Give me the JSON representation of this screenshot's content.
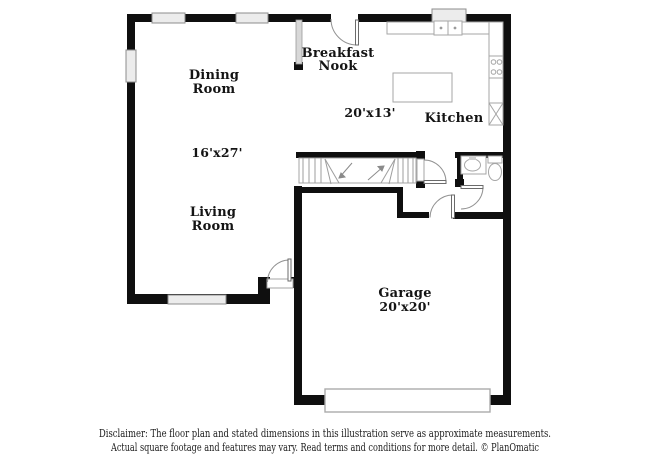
{
  "plan": {
    "rooms": {
      "dining": {
        "line1": "Dining",
        "line2": "Room"
      },
      "breakfast": {
        "line1": "Breakfast",
        "line2": "Nook"
      },
      "kitchen": {
        "label": "Kitchen",
        "dimensions": "20'x13'"
      },
      "living": {
        "line1": "Living",
        "line2": "Room",
        "dimensions": "16'x27'"
      },
      "garage": {
        "label": "Garage",
        "dimensions": "20'x20'"
      }
    },
    "fixtures": [
      "double-sink",
      "stove",
      "island",
      "pantry-x-box",
      "bath-sink",
      "toilet",
      "stairs",
      "garage-door"
    ],
    "colors": {
      "wall": "#0f0f0f",
      "fixture_outline": "#a6a6a6",
      "window_fill": "#ececec",
      "background": "#ffffff"
    }
  },
  "footer": {
    "line1": "Disclaimer: The floor plan and stated dimensions in this illustration serve as approximate measurements.",
    "line2": "Actual square footage and features may vary. Read terms and conditions for more detail. © PlanOmatic"
  }
}
